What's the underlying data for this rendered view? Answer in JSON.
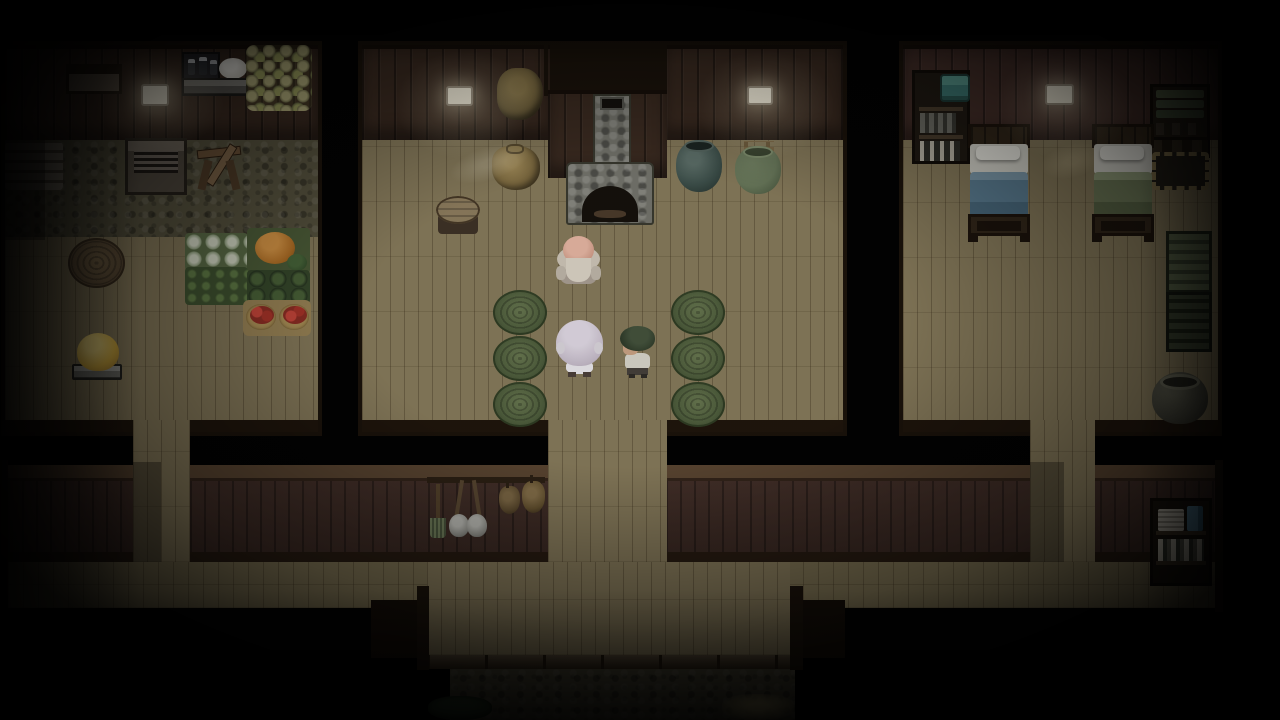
{
  "window": {
    "title": "RPG farmhouse interior — night scene",
    "type": "game-viewport"
  },
  "scene": {
    "setting": "Top-down pixel-art farmhouse interior at night: three rooms joined by a south hallway with an exit to a stone path",
    "rooms": [
      {
        "id": "kitchen",
        "label": "kitchen storeroom",
        "items": [
          "wall alcove shelf",
          "oil lamp",
          "iron stove with bottles",
          "white dough pot",
          "hanging onion strings",
          "firewood pile",
          "stone hearth",
          "sawhorse with log",
          "round wicker mat",
          "cabbage basket",
          "pumpkin basket",
          "leafy greens basket",
          "melon basket",
          "tomato baskets",
          "bread loaf on scale"
        ]
      },
      {
        "id": "main-room",
        "label": "main room with fireplace",
        "items": [
          "oil lamp west",
          "hanging hay bundle",
          "stone chimney",
          "stone fireplace",
          "grain sack",
          "round wooden stool",
          "dark glazed jar",
          "green glazed jar",
          "wall ladder rack",
          "oil lamp east",
          "six green woven mats"
        ]
      },
      {
        "id": "bedroom",
        "label": "bedroom",
        "items": [
          "bookshelf with teal chest",
          "oil lamp",
          "bed with blue blanket",
          "bed with green blanket",
          "shelf of folded green blankets",
          "dark storage crate",
          "woven basket",
          "green slatted cabinet",
          "dark slatted cabinet",
          "iron cauldron"
        ]
      },
      {
        "id": "hallway",
        "label": "south hallway",
        "items": [
          "broom",
          "two hanging shovels",
          "two hanging pouches",
          "bookshelf with papers and blue book",
          "exit doorway",
          "stone path",
          "bush",
          "dry grass tuft"
        ]
      }
    ],
    "characters": [
      {
        "id": "elder-man",
        "label": "bald old man with white beard and grey robe",
        "room": "main-room"
      },
      {
        "id": "elder-woman",
        "label": "white-haired elder seen from behind",
        "room": "main-room"
      },
      {
        "id": "child",
        "label": "dark-haired child in white shirt facing the elder",
        "room": "main-room"
      }
    ],
    "palette": {
      "floor": "#85795a",
      "north_wall": "#3b2b21",
      "hall_wall": "#45312a",
      "stone": "#56523e",
      "mat_green": "#50603e",
      "lamp_glow": "#fff4d0",
      "blanket_blue": "#5b7d92",
      "blanket_green": "#6f7b59",
      "tomato_red": "#b23a2e",
      "pumpkin_orange": "#c07a2e",
      "bread_yellow": "#d8b84a",
      "chest_teal": "#3f7d78"
    }
  }
}
